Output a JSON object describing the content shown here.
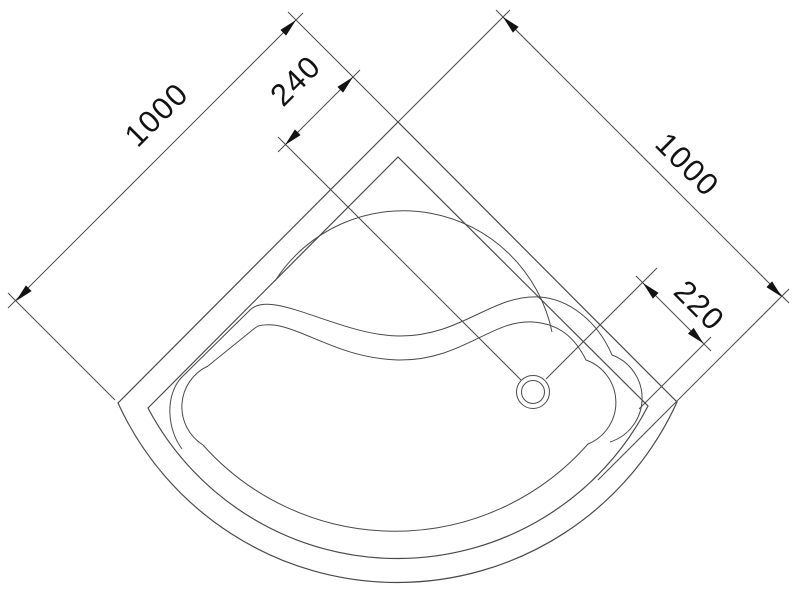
{
  "drawing": {
    "dims": {
      "upper_left": "1000",
      "upper_right": "1000",
      "top_center": "240",
      "right_lower": "220"
    }
  },
  "icons": {
    "drain": "drain-circle"
  },
  "colors": {
    "line": "#4a4a4a",
    "text": "#121212",
    "background": "#ffffff"
  }
}
